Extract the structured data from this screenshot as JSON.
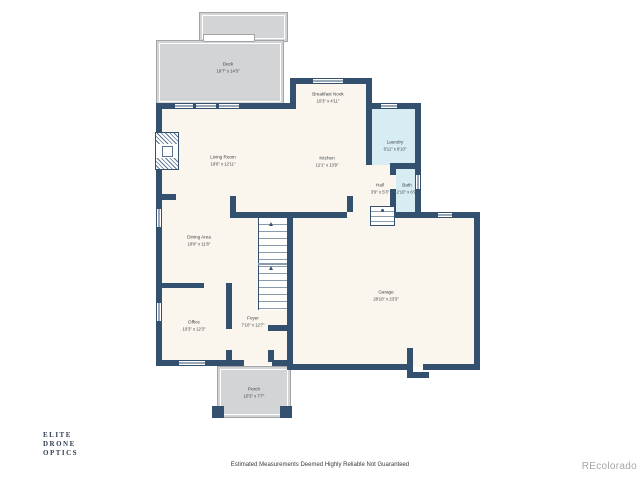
{
  "watermark": {
    "line1": "ELITE",
    "line2": "DRONE",
    "line3": "OPTICS"
  },
  "brand": "REcolorado",
  "footer": {
    "disclaimer": "Estimated Measurements Deemed Highly Reliable Not Guaranteed"
  },
  "colors": {
    "wall": "#33516f",
    "floor": "#faf6ed",
    "wet": "#d8ecf4",
    "deck": "#d2d4d5",
    "deckline": "#a2a4a7",
    "watermark": "#2e3d4e",
    "brandgray": "#a6a6a6"
  },
  "rooms": [
    {
      "name": "Deck",
      "dims": "16'7\" x 14'3\""
    },
    {
      "name": "Breakfast Nook",
      "dims": "10'3\" x 4'11\""
    },
    {
      "name": "Living Room",
      "dims": "19'6\" x 12'11\""
    },
    {
      "name": "Kitchen",
      "dims": "12'1\" x 13'9\""
    },
    {
      "name": "Laundry",
      "dims": "6'11\" x 8'10\""
    },
    {
      "name": "Hall",
      "dims": "3'9\" x 5'3\""
    },
    {
      "name": "Bath",
      "dims": "2'10\" x 6'9\""
    },
    {
      "name": "Dining Area",
      "dims": "18'8\" x 11'8\""
    },
    {
      "name": "Garage",
      "dims": "28'10\" x 23'3\""
    },
    {
      "name": "Office",
      "dims": "10'3\" x 12'3\""
    },
    {
      "name": "Foyer",
      "dims": "7'10\" x 12'7\""
    },
    {
      "name": "Porch",
      "dims": "10'3\" x 7'7\""
    }
  ]
}
